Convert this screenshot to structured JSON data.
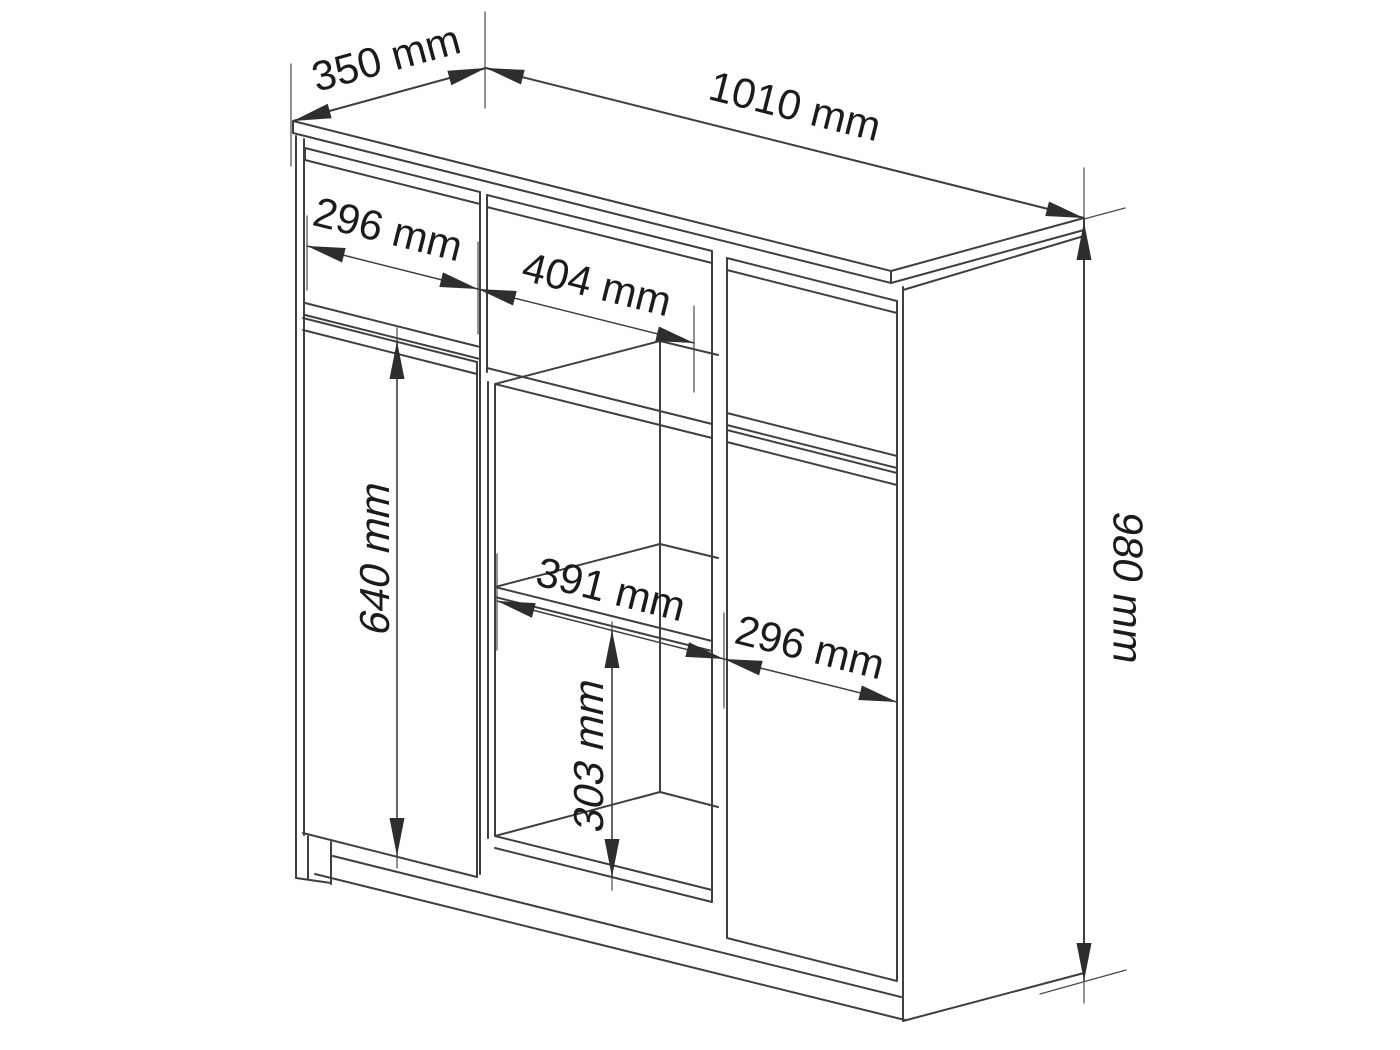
{
  "diagram": {
    "unit": "mm",
    "colors": {
      "background": "#ffffff",
      "line": "#3f3f3f",
      "text": "#1b1b1b"
    },
    "dimensions": {
      "depth": {
        "label": "350 mm",
        "value": 350
      },
      "width": {
        "label": "1010 mm",
        "value": 1010
      },
      "left_drawer_width": {
        "label": "296 mm",
        "value": 296
      },
      "middle_drawer_width": {
        "label": "404 mm",
        "value": 404
      },
      "left_door_height": {
        "label": "640 mm",
        "value": 640
      },
      "shelf_compartment_width": {
        "label": "391 mm",
        "value": 391
      },
      "right_door_width": {
        "label": "296 mm",
        "value": 296
      },
      "lower_compartment_height": {
        "label": "303 mm",
        "value": 303
      },
      "total_height": {
        "label": "980 mm",
        "value": 980
      }
    }
  }
}
